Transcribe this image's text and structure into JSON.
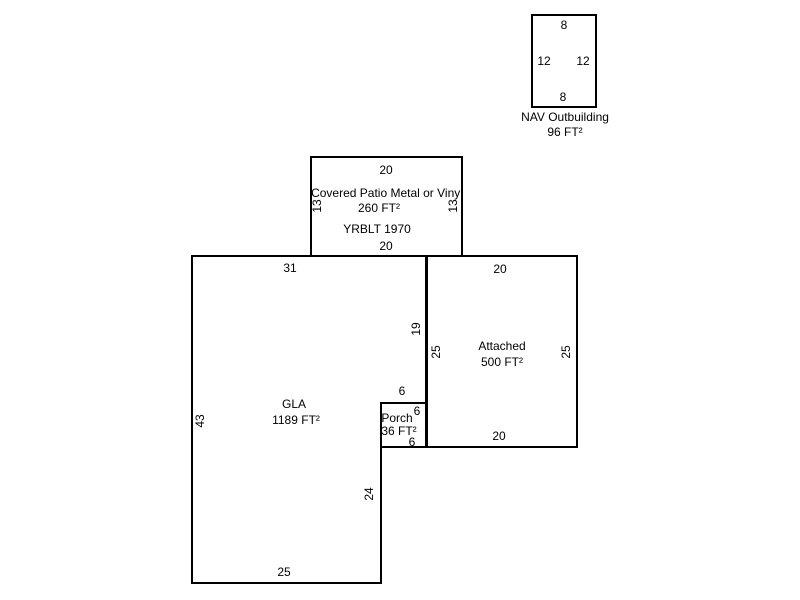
{
  "sketch": {
    "background_color": "#ffffff",
    "line_color": "#000000",
    "text_color": "#000000",
    "buildings": {
      "nav_outbuilding": {
        "name": "NAV Outbuilding",
        "area": "96 FT²",
        "dim_top": "8",
        "dim_left": "12",
        "dim_right": "12",
        "dim_bottom": "8"
      },
      "covered_patio": {
        "name": "Covered Patio Metal or Vinyl",
        "area": "260 FT²",
        "year_built": "YRBLT 1970",
        "dim_top": "20",
        "dim_left": "13",
        "dim_right": "13",
        "dim_bottom": "20"
      },
      "gla": {
        "name": "GLA",
        "area": "1189 FT²",
        "dim_top": "31",
        "dim_left": "43",
        "dim_bottom": "25",
        "dim_right_upper": "19",
        "dim_notch_top": "6",
        "dim_right_lower": "24"
      },
      "porch": {
        "name": "Porch",
        "area": "36 FT²",
        "dim_right": "6",
        "dim_bottom": "6"
      },
      "attached": {
        "name": "Attached",
        "area": "500 FT²",
        "dim_top": "20",
        "dim_left": "25",
        "dim_right": "25",
        "dim_bottom": "20"
      }
    }
  }
}
